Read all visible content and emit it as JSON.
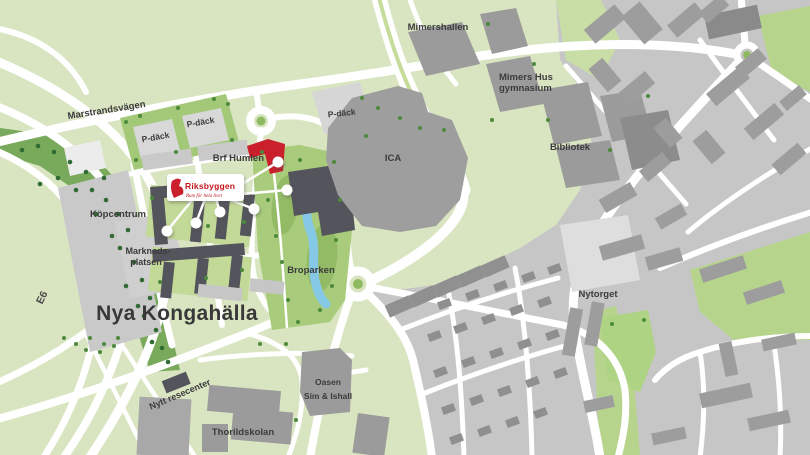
{
  "map": {
    "labels": {
      "marstrandsvagen": "Marstrandsvägen",
      "pdack_west_1": "P-däck",
      "pdack_west_2": "P-däck",
      "pdack_ica": "P-däck",
      "brf_humlen": "Brf Humlen",
      "kopcentrum": "Köpcentrum",
      "marknadsplatsen": [
        "Marknads-",
        "platsen"
      ],
      "nya_kongahalla": "Nya Kongahälla",
      "e6": "E6",
      "broparken": "Broparken",
      "mimershallen": "Mimershallen",
      "mimers_hus": [
        "Mimers Hus",
        "gymnasium"
      ],
      "ica": "ICA",
      "bibliotek": "Bibliotek",
      "nytorget": "Nytorget",
      "nytt_resecenter": "Nytt resecenter",
      "oasen": [
        "Oasen",
        "Sim & Ishall"
      ],
      "thorildskolan": "Thorildskolan"
    },
    "logo": {
      "brand": "Riksbyggen",
      "tagline": "Rum för hela livet"
    },
    "colors": {
      "background_green": "#d9e5c1",
      "park_green": "#a9cb7c",
      "woods_green": "#79a95b",
      "urban_gray": "#c6c6c6",
      "building_gray": "#9d9d9d",
      "building_dark": "#54555c",
      "accent_red": "#c9202c",
      "water_blue": "#86c9e6",
      "road_white": "#ffffff"
    }
  }
}
